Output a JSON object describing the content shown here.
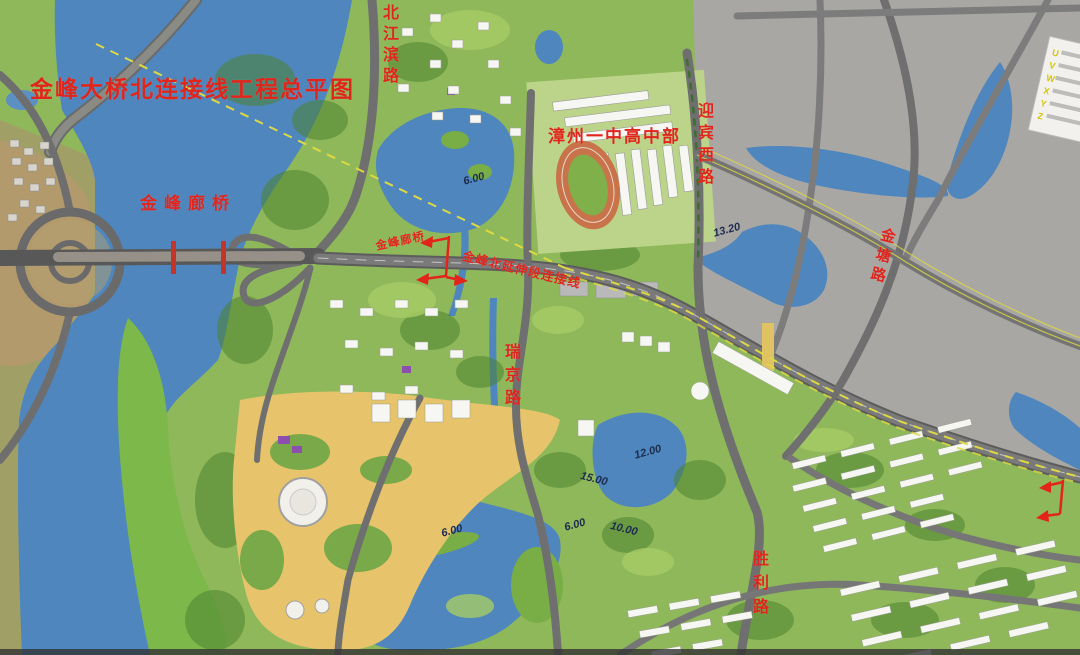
{
  "title": "金峰大桥北连接线工程总平图",
  "labels": {
    "beijiangbin_road": "北江滨路",
    "school": "漳州一中高中部",
    "yingbin_west_road": "迎宾西路",
    "jintang_road": "金塘路",
    "jinfeng_gallery_bridge": "金峰廊桥",
    "jinfeng_gallery_bridge_small": "金峰廊桥",
    "north_extension_connection": "金峰北延伸段连接线",
    "ruijing_road": "瑞京路",
    "shengli_road": "胜利路"
  },
  "elevations": [
    {
      "text": "6.00"
    },
    {
      "text": "13.20"
    },
    {
      "text": "12.00"
    },
    {
      "text": "6.00"
    },
    {
      "text": "6.00"
    },
    {
      "text": "15.00"
    },
    {
      "text": "10.00"
    }
  ],
  "legend": {
    "keys": [
      "U",
      "V",
      "W",
      "X",
      "Y",
      "Z"
    ]
  },
  "colors": {
    "annotation_red": "#e3241b",
    "water": "#4e86bd",
    "survey_yellow": "#ded943"
  }
}
